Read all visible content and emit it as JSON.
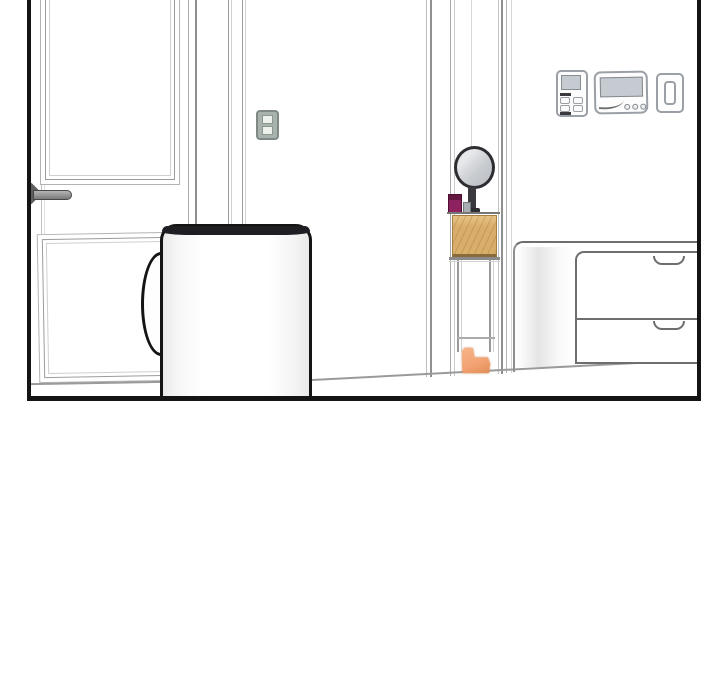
{
  "page": {
    "type": "comic-panel",
    "description": "Black-bordered webtoon panel of a room interior, cropped at top, empty white space below"
  },
  "colors": {
    "ink": "#141414",
    "line": "#9a9a9a",
    "line-soft": "#c9c9c9",
    "line-dark": "#6e6e6e",
    "mug-rim": "#1f1f23",
    "mirror-rim": "#2e2e32",
    "mirror-glass": "#c8cbcf",
    "magenta": "#8e2261",
    "magenta-dark": "#63163f",
    "wood": "#d9ad6a",
    "wood-light": "#e7c286",
    "wood-shadow": "#8a6a3a",
    "wood-edge": "#a87f44",
    "orange": "#f2a273",
    "orange-edge": "#c87840",
    "switch-body": "#a9b3ad",
    "switch-frame": "#7f8a84",
    "switch-key": "#edf1ec",
    "device-line": "#9aa0a5",
    "screen": "#c5cbd1",
    "dark-accent": "#3a3a3e",
    "handle-gray": "#8c8c8c"
  },
  "scene": {
    "panel": {
      "label": "comic panel of room interior"
    },
    "door": {
      "label": "white paneled door"
    },
    "door_upper_panel": {
      "label": "door upper recessed panel"
    },
    "door_lower_panel": {
      "label": "door lower recessed panel"
    },
    "door_handle": {
      "label": "gray lever door handle"
    },
    "light_switch": {
      "label": "wall light switch with two rockers"
    },
    "door_frame": {
      "label": "door jamb molding"
    },
    "closet_gap": {
      "label": "narrow open doorway showing shelf"
    },
    "mirror": {
      "label": "round vanity mirror on stand"
    },
    "cosmetic_box": {
      "label": "magenta cosmetic box"
    },
    "small_item": {
      "label": "small gray item"
    },
    "wooden_box": {
      "label": "wooden organizer box on shelf"
    },
    "shelf": {
      "label": "slim shelf rack with legs"
    },
    "slipper": {
      "label": "orange slipper on floor"
    },
    "intercom": {
      "label": "wall intercom panel with screen and buttons"
    },
    "thermostat": {
      "label": "wall thermostat with display and dials"
    },
    "switch_plate": {
      "label": "small wall switch plate"
    },
    "dresser": {
      "label": "white dresser with rounded top"
    },
    "drawer_top": {
      "label": "top drawer with scooped handle"
    },
    "drawer_bottom": {
      "label": "bottom drawer with scooped handle"
    },
    "floor": {
      "label": "floor line"
    },
    "mug": {
      "label": "large white mug in foreground"
    },
    "mug_handle": {
      "label": "mug handle"
    }
  }
}
